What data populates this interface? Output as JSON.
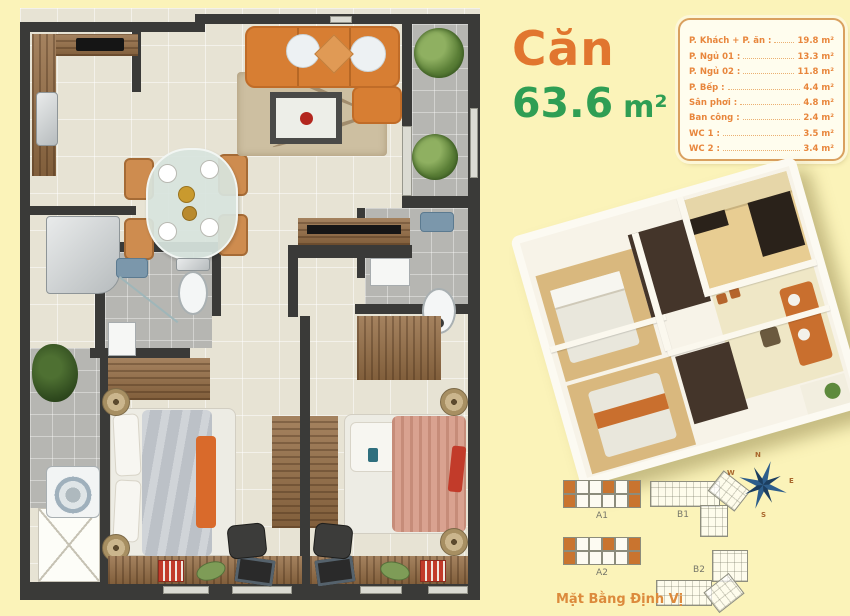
{
  "background": "#FBF3B9",
  "title": {
    "word": "Căn",
    "area": "63.6",
    "unit": "m²"
  },
  "legend": {
    "rows": [
      {
        "label": "P. Khách + P. ăn :",
        "value": "19.8 m²"
      },
      {
        "label": "P. Ngủ 01 :",
        "value": "13.3 m²"
      },
      {
        "label": "P. Ngủ 02 :",
        "value": "11.8 m²"
      },
      {
        "label": "P. Bếp :",
        "value": "4.4 m²"
      },
      {
        "label": "Sân phơi :",
        "value": "4.8 m²"
      },
      {
        "label": "Ban công :",
        "value": "2.4 m²"
      },
      {
        "label": "WC 1 :",
        "value": "3.5 m²"
      },
      {
        "label": "WC 2 :",
        "value": "3.4 m²"
      }
    ]
  },
  "site_plan": {
    "caption": "Mặt Bằng Định Vị",
    "blocks": {
      "a1": "A1",
      "b1": "B1",
      "a2": "A2",
      "b2": "B2"
    },
    "compass": {
      "n": "N",
      "e": "E",
      "s": "S",
      "w": "W"
    }
  },
  "colors": {
    "title_orange": "#E1762F",
    "title_green": "#2F9E54",
    "legend_text": "#E8863C",
    "wall": "#3A3A38",
    "floor_beige": "#E7E3D4",
    "tile_gray": "#B6B6B2",
    "wood": "#966E45",
    "sofa_orange": "#D77E33",
    "compass_blue": "#2E5E8C"
  }
}
